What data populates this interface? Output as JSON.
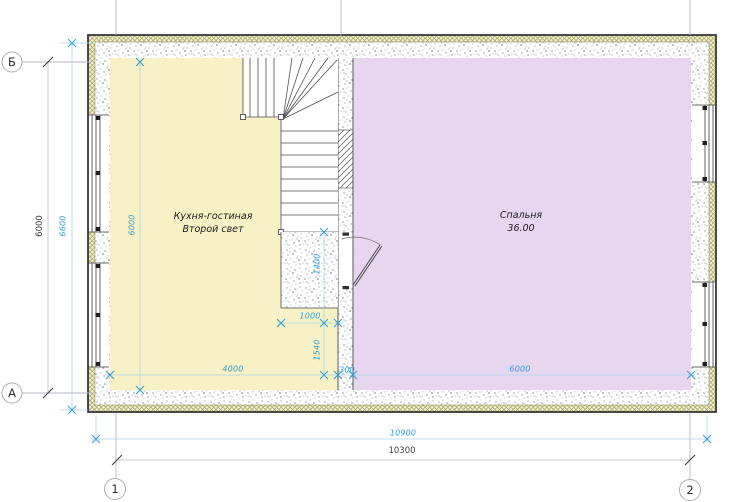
{
  "plan": {
    "rooms": {
      "kitchen": {
        "line1": "Кухня-гостиная",
        "line2": "Второй свет"
      },
      "bedroom": {
        "name": "Спальня",
        "area": "36.00"
      }
    },
    "grid_axes": {
      "row_top": "Б",
      "row_bottom": "А",
      "col_left": "1",
      "col_right": "2"
    },
    "dimensions": {
      "outer_height_blue": "6600",
      "axis_height_black": "6000",
      "kitchen_interior_height": "6000",
      "stair_landing_depth": "1400",
      "below_landing": "1540",
      "stair_width": "1000",
      "kitchen_width": "4000",
      "partition_thickness": "300",
      "bedroom_width": "6000",
      "outer_width_blue": "10900",
      "axis_width_black": "10300"
    },
    "colors": {
      "kitchen_fill": "#f7f1c5",
      "bedroom_fill": "#e6d6f0",
      "dimension_blue": "#2f9fd6",
      "wall_hatch_olive": "#a9a158",
      "line_dark": "#3d3d3d",
      "grid_gray": "#adb5bb"
    }
  }
}
